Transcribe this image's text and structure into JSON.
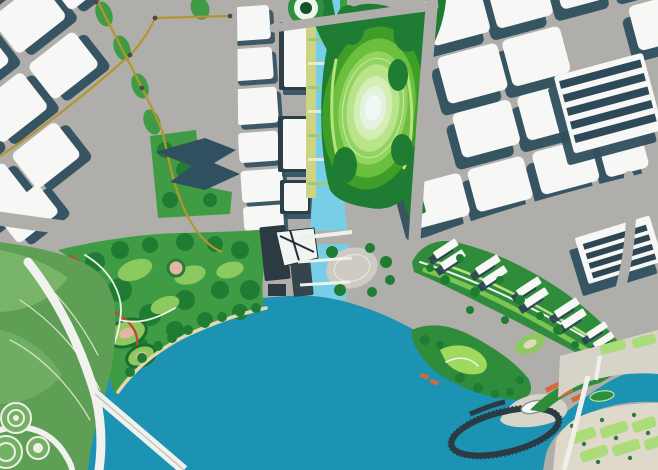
{
  "scene": {
    "type": "urban-waterfront-master-plan-aerial-rendering",
    "regions": [
      "city-blocks-northwest",
      "city-blocks-northeast",
      "exhibition-halls",
      "central-canal",
      "great-lawn-ellipse-park",
      "central-waterfront-park",
      "residential-green-band",
      "harbour-bay",
      "leaf-shaped-park",
      "pier-ring-boardwalk",
      "east-canal",
      "southeast-plaza",
      "golden-skywalk"
    ]
  },
  "palette": {
    "base": "#b0aeab",
    "building": "#f7f8f5",
    "shadow": "#31505f",
    "canal": "#76cfe6",
    "bay": "#1d93b4",
    "park_dark": "#1f7d33",
    "park_mid": "#3f9c45",
    "park_band": "#2f8c3b",
    "lawn": "#8cc95e",
    "lawn_pale": "#abdc79",
    "gold": "#b3962f",
    "trail_red": "#bf4a36",
    "plaza": "#ded9cb",
    "plaza_strip": "#d6d3c8",
    "plaza_oval": "#cfcbc2",
    "pier": "#2b3b44",
    "roof_orange": "#d4693c",
    "leaf": "#5f9e55",
    "leaf_light": "#79b569",
    "path_white": "#f1f2ee",
    "bank": "#cdd584",
    "promenade": "#e7d7ae",
    "tower_dark": "#2c3a42",
    "pink": "#e3b7a4",
    "island": "#2e8f3f",
    "rings": [
      "#3e9e27",
      "#6abf3e",
      "#93d35f",
      "#b9e48c",
      "#d4eeb5",
      "#e4f2e0",
      "#eff8f3"
    ]
  }
}
